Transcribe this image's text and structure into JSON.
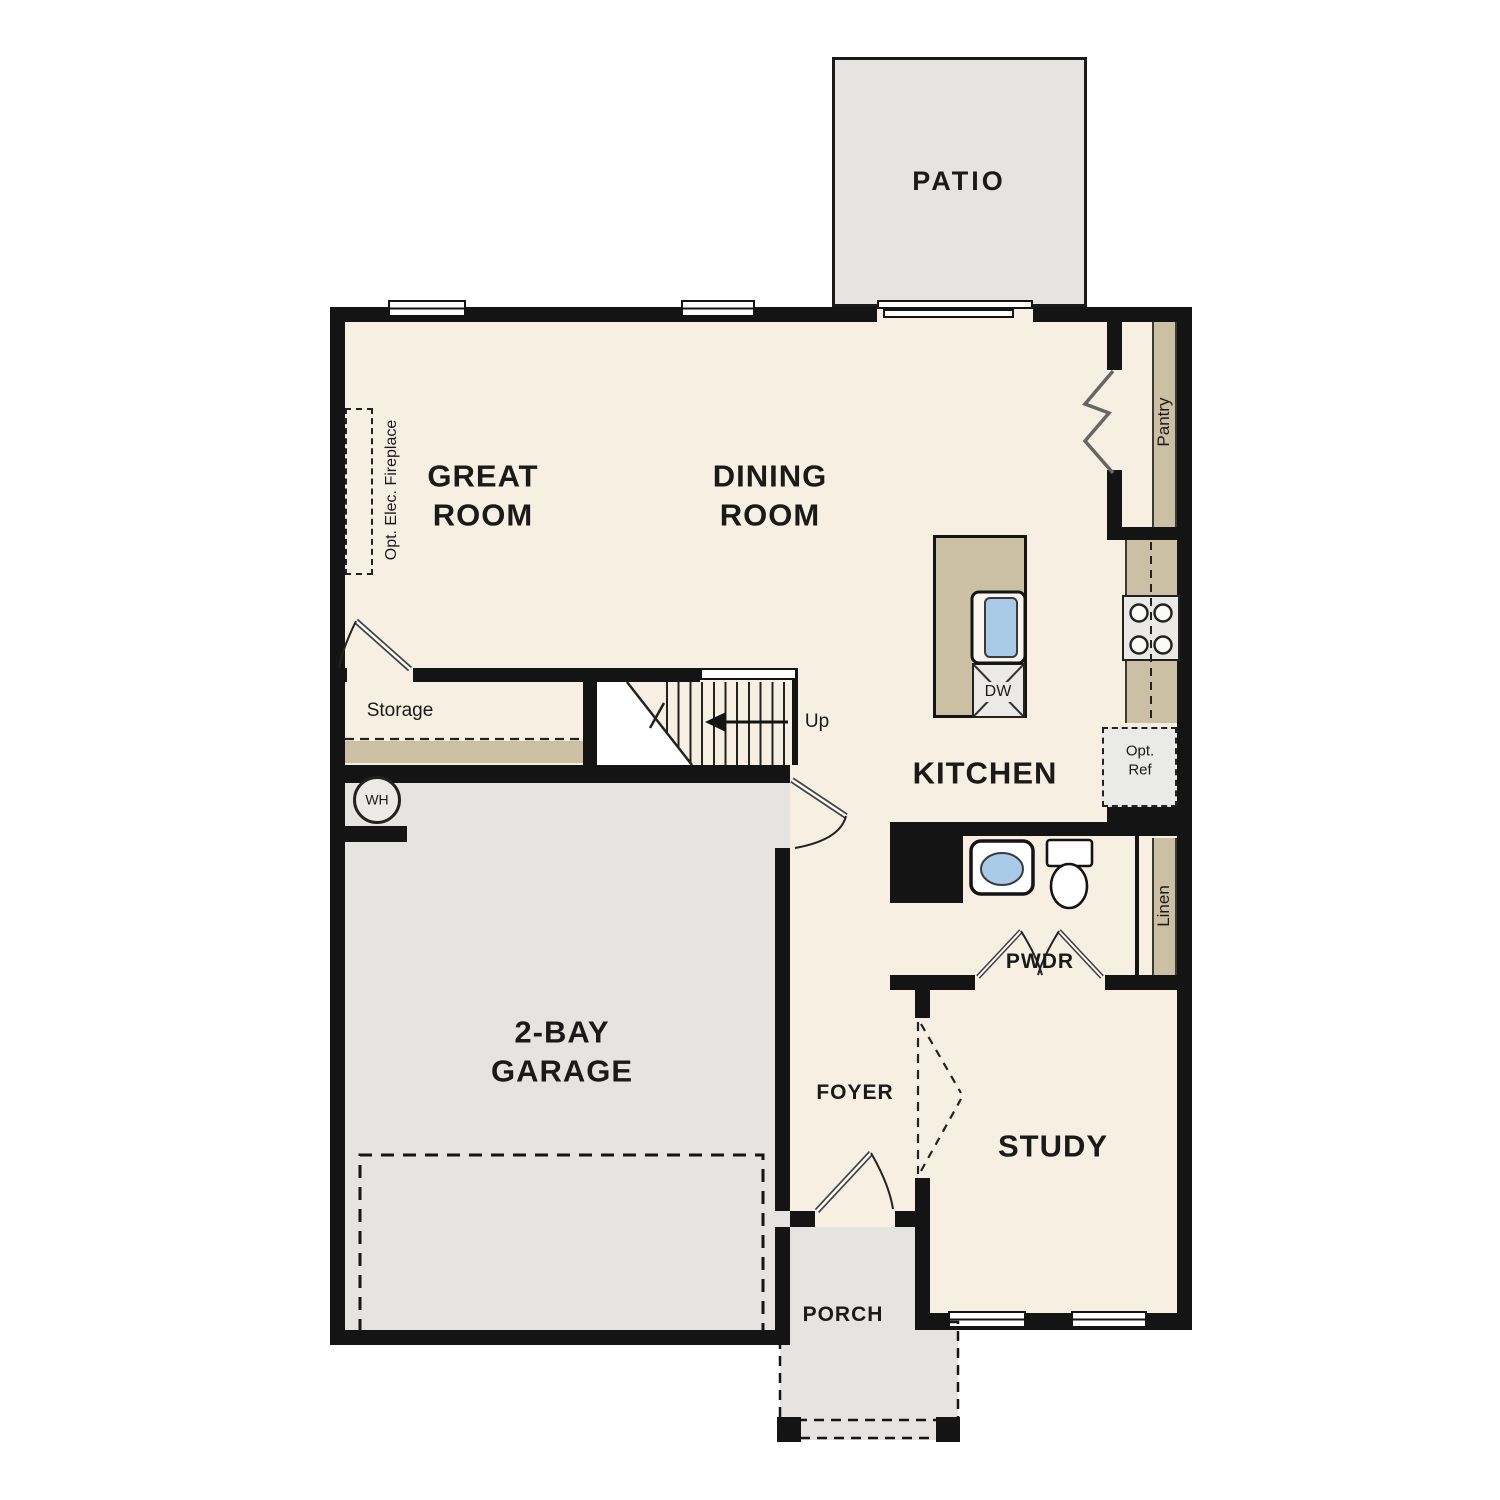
{
  "plan": {
    "rooms": {
      "patio": "PATIO",
      "great_room": "GREAT\nROOM",
      "dining_room": "DINING\nROOM",
      "kitchen": "KITCHEN",
      "garage": "2-BAY\nGARAGE",
      "foyer": "FOYER",
      "study": "STUDY",
      "porch": "PORCH",
      "powder": "PWDR"
    },
    "features": {
      "storage": "Storage",
      "pantry": "Pantry",
      "linen": "Linen",
      "stairs_up": "Up",
      "water_heater": "WH",
      "dishwasher": "DW",
      "optional_refrigerator": "Opt.\nRef",
      "optional_fireplace": "Opt. Elec. Fireplace"
    },
    "colors": {
      "floor": "#f7efe2",
      "exterior_concrete": "#e6e4e1",
      "casework": "#ccc0a4",
      "wall": "#141414",
      "fixture_blue": "#a9cbe8"
    }
  }
}
